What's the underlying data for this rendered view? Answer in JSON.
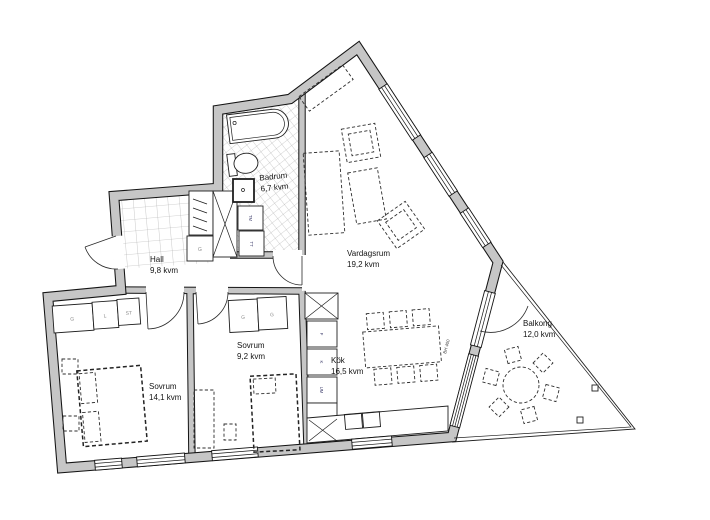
{
  "rooms": {
    "hall": {
      "name": "Hall",
      "area": "9,8 kvm"
    },
    "badrum": {
      "name": "Badrum",
      "area": "6,7 kvm"
    },
    "vardagsrum": {
      "name": "Vardagsrum",
      "area": "19,2 kvm"
    },
    "sovrum_large": {
      "name": "Sovrum",
      "area": "14,1 kvm"
    },
    "sovrum_small": {
      "name": "Sovrum",
      "area": "9,2 kvm"
    },
    "kok": {
      "name": "Kök",
      "area": "16,5 kvm"
    },
    "balkong": {
      "name": "Balkong",
      "area": "12,0 kvm"
    }
  },
  "closets": {
    "hall_g": "G",
    "bedroom_large_row": [
      "G",
      "L",
      "ST"
    ],
    "bedroom_small_row": [
      "G",
      "G"
    ]
  },
  "appliances": {
    "freezer": "F",
    "fridge": "K",
    "oven": "UM",
    "washer": "TM",
    "dryer": "TT"
  },
  "annotations": {
    "window_sill": "BH 400"
  },
  "colors": {
    "wall_fill": "#c6c6c6",
    "line": "#141414",
    "furniture_line": "#2e2e2e",
    "tile_line": "#a6a6a6"
  }
}
